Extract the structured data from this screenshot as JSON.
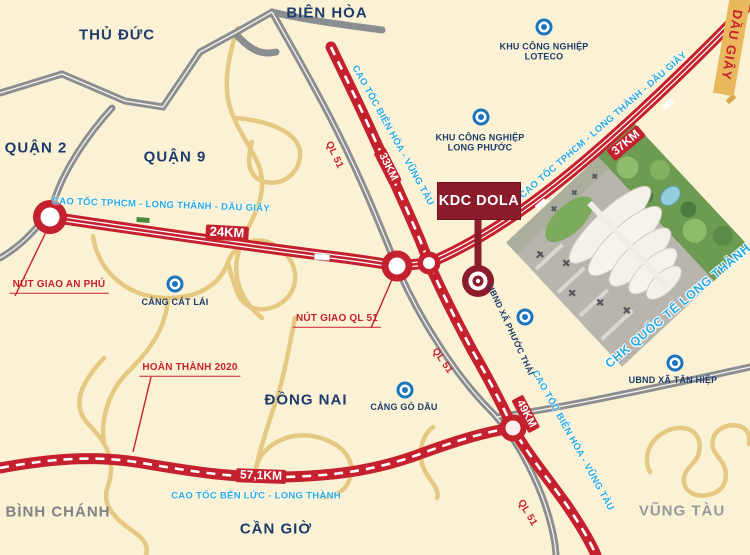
{
  "map": {
    "colors": {
      "highway": "#c5202d",
      "road_gray": "#8b8e91",
      "road_yellow": "#e5c983",
      "accent_cyan": "#29abe2",
      "navy": "#1d3b6b",
      "red": "#c9202c",
      "maroon": "#8c1b2c",
      "background": "#fbf2d5",
      "dau_giay_bg": "#e9b85d"
    },
    "regions": [
      {
        "label": "THỦ ĐỨC"
      },
      {
        "label": "BIÊN HÒA"
      },
      {
        "label": "QUẬN 2"
      },
      {
        "label": "QUẬN 9"
      },
      {
        "label": "ĐỒNG NAI"
      },
      {
        "label": "CẦN GIỜ"
      },
      {
        "label": "BÌNH CHÁNH"
      },
      {
        "label": "VŨNG TÀU"
      }
    ],
    "highways": [
      {
        "name": "CAO TỐC TPHCM - LONG THÀNH - DẦU GIÂY",
        "distances": [
          "24KM",
          "37KM"
        ]
      },
      {
        "name": "CAO TỐC BIÊN HÒA - VŨNG TÀU",
        "distances": [
          "33KM",
          "49KM"
        ]
      },
      {
        "name": "CAO TỐC BẾN LỨC - LONG THÀNH",
        "distances": [
          "57,1KM"
        ]
      }
    ],
    "national_road": {
      "label": "QL 51"
    },
    "junctions": [
      {
        "label": "NÚT GIAO AN PHÚ"
      },
      {
        "label": "NÚT GIAO QL 51"
      }
    ],
    "pois": [
      {
        "lines": [
          "KHU CÔNG NGHIỆP",
          "LOTECO"
        ]
      },
      {
        "lines": [
          "KHU CÔNG NGHIỆP",
          "LONG PHƯỚC"
        ]
      },
      {
        "lines": [
          "CẢNG CÁT LÁI"
        ]
      },
      {
        "lines": [
          "CẢNG GÒ DẦU"
        ]
      },
      {
        "lines": [
          "UBND XÃ PHƯỚC THÁI"
        ]
      },
      {
        "lines": [
          "UBND XÃ TÂN HIỆP"
        ]
      }
    ],
    "project": {
      "label": "KDC DOLA"
    },
    "airport": {
      "label": "CHK QUỐC TẾ LONG THÀNH"
    },
    "notes": {
      "completion": "HOÀN THÀNH 2020",
      "dau_giay": "DẦU GIÂY"
    }
  }
}
